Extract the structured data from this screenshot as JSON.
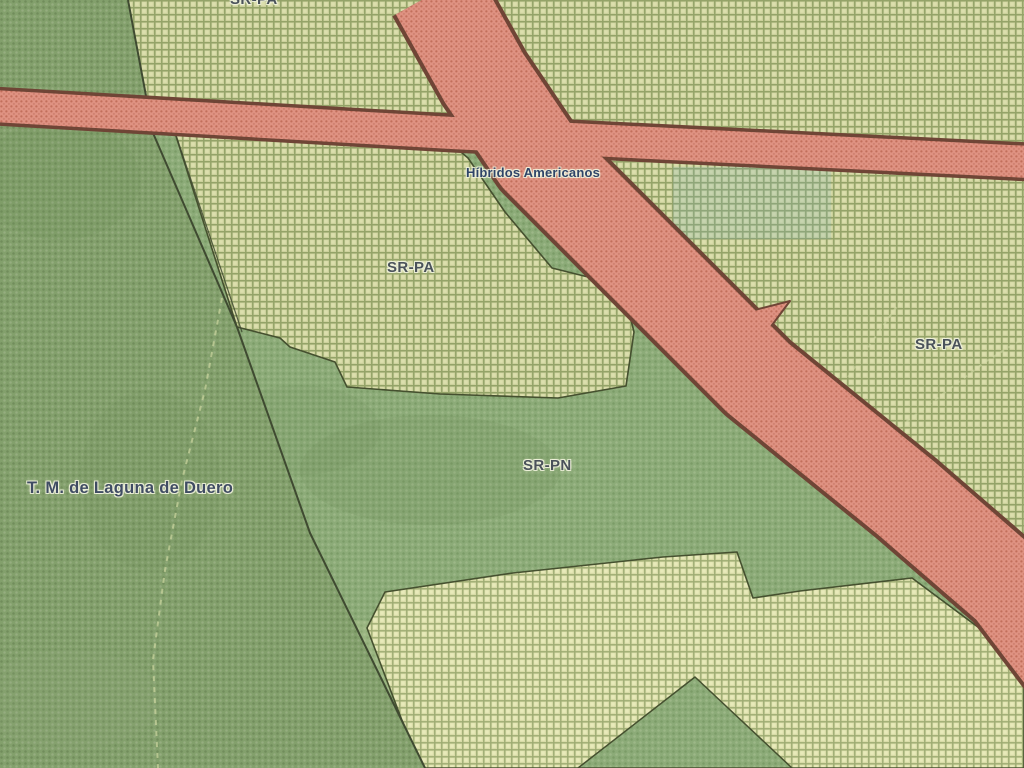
{
  "labels": {
    "municipality": {
      "text": "T. M. de Laguna de Duero"
    },
    "road_name": {
      "text": "Híbridos Americanos"
    },
    "zone_top": {
      "text": "SR-PA"
    },
    "zone_middle": {
      "text": "SR-PA"
    },
    "zone_right": {
      "text": "SR-PA"
    },
    "zone_bottom": {
      "text": "SR-PN"
    }
  },
  "zones": [
    {
      "code": "SR-PA",
      "style": "green-crosshatch"
    },
    {
      "code": "SR-PN",
      "style": "green-dotted"
    },
    {
      "code": "T. M. de Laguna de Duero",
      "style": "olive-mottled"
    }
  ],
  "colors": {
    "zone_crosshatch_bg": "#ccd19c",
    "zone_crosshatch_line": "#94a368",
    "zone_light_bg": "#d9dca8",
    "zone_dots_bg": "#8cab78",
    "municipality_bg": "#83a06c",
    "road_fill": "#df9282",
    "road_dot": "#c26f5c",
    "road_border": "#6f4536",
    "boundary_line": "#3f4a31",
    "water_overlay": "#7fb2b8",
    "label_zone": "#4a525a",
    "label_road": "#2f4468",
    "label_municipality": "#3f4c63"
  }
}
